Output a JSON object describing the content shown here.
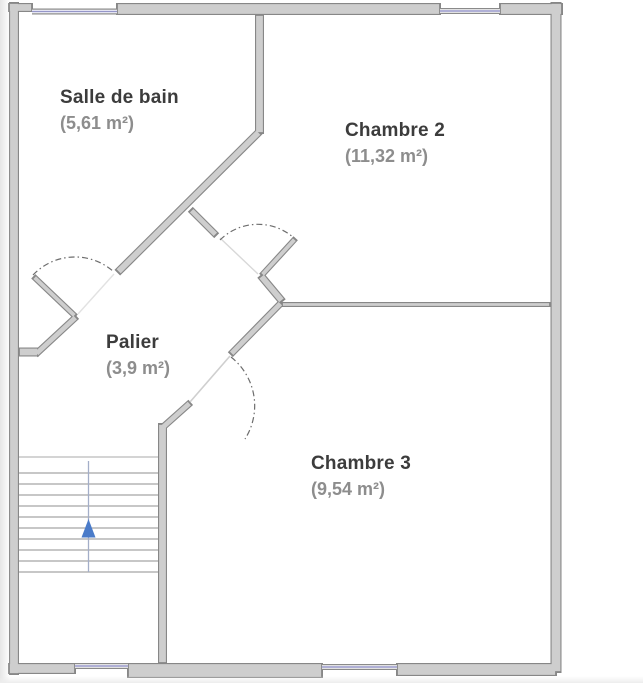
{
  "rooms": [
    {
      "name": "Salle de bain",
      "area": "(5,61 m²)"
    },
    {
      "name": "Chambre 2",
      "area": "(11,32 m²)"
    },
    {
      "name": "Palier",
      "area": "(3,9 m²)"
    },
    {
      "name": "Chambre 3",
      "area": "(9,54 m²)"
    }
  ],
  "stairs": {
    "direction_arrow": "up"
  },
  "colors": {
    "wall_fill": "#cecece",
    "wall_edge": "#878787",
    "window_glass": "#9596c9",
    "window_frame": "#8a8a8a",
    "door_arc": "#6d6d6d",
    "door_leaf": "#cfcfcf",
    "stair_tread": "#8f8f8f",
    "stair_center_line": "#a3aec8",
    "stair_arrow": "#4a7bc9",
    "room_name_text": "#3c3c3c",
    "room_area_text": "#8d8d8d"
  }
}
